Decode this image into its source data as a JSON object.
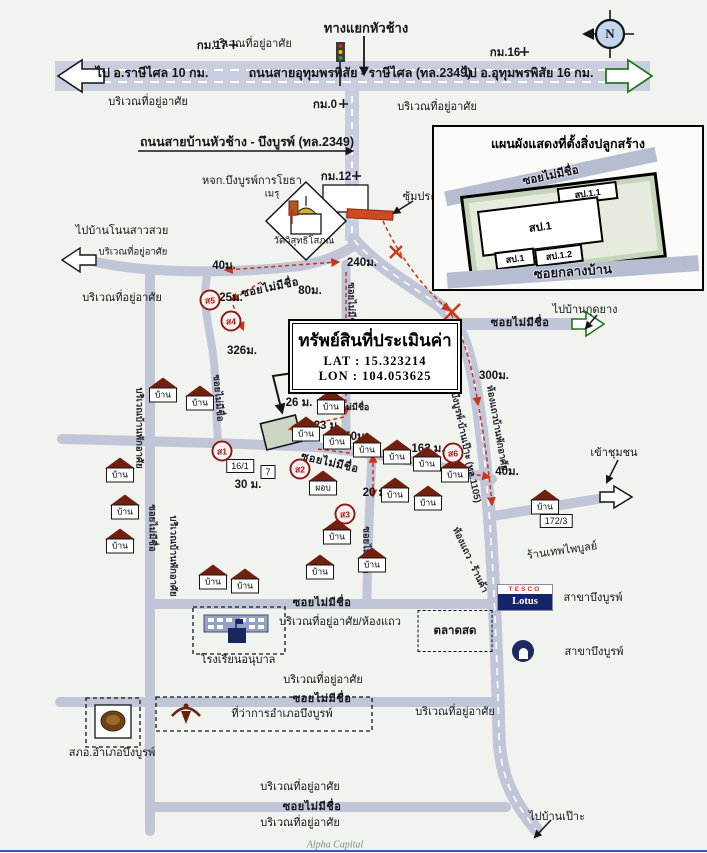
{
  "colors": {
    "road": "#c0c6d8",
    "road_band": "#c9cedf",
    "route": "#c93515",
    "roof": "#731f10",
    "green_arrow": "#1e7a1e",
    "lotus_navy": "#142468",
    "tesco_red": "#d42a10"
  },
  "property_box": {
    "title": "ทรัพย์สินที่ประเมินค่า",
    "lat": "LAT : 15.323214",
    "lon": "LON : 104.053625"
  },
  "inset": {
    "title": "แผนผังแสดงที่ตั้งสิ่งปลูกสร้าง",
    "road_top": "ซอยไม่มีชื่อ",
    "road_bottom": "ซอยกลางบ้าน",
    "b11": "สป.1.1",
    "b1": "สป.1",
    "b1s": "สป.1",
    "b12": "สป.1.2"
  },
  "lotus": {
    "tesco": "TESCO",
    "lotus": "Lotus"
  },
  "footer": {
    "brand": "Alpha Capital"
  },
  "house_label": "บ้าน",
  "labels": [
    {
      "t": "ทางแยกหัวช้าง",
      "x": 366,
      "y": 28,
      "c": "hdr",
      "n": "junction-label"
    },
    {
      "t": "บริเวณที่อยู่อาศัย",
      "x": 252,
      "y": 43,
      "c": "t",
      "n": "area-label"
    },
    {
      "t": "กม.17",
      "x": 212,
      "y": 46,
      "c": "b",
      "n": "km-marker-label"
    },
    {
      "t": "กม.16",
      "x": 505,
      "y": 53,
      "c": "b",
      "n": "km-marker-label"
    },
    {
      "t": "ไป อ.ราษีไศล 10 กม.",
      "x": 152,
      "y": 73,
      "c": "big",
      "n": "destination-label"
    },
    {
      "t": "ถนนสายอุทุมพรพิสัย - ราษีไศล (ทล.2349)",
      "x": 360,
      "y": 73,
      "c": "big",
      "n": "road-name-label"
    },
    {
      "t": "ไป อ.อุทุมพรพิสัย 16 กม.",
      "x": 528,
      "y": 73,
      "c": "big",
      "n": "destination-label"
    },
    {
      "t": "บริเวณที่อยู่อาศัย",
      "x": 148,
      "y": 101,
      "c": "t",
      "n": "area-label"
    },
    {
      "t": "กม.0",
      "x": 325,
      "y": 105,
      "c": "b",
      "n": "km-marker-label"
    },
    {
      "t": "บริเวณที่อยู่อาศัย",
      "x": 437,
      "y": 106,
      "c": "t",
      "n": "area-label"
    },
    {
      "t": "ถนนสายบ้านหัวช้าง - บึงบูรพ์ (ทล.2349)",
      "x": 247,
      "y": 142,
      "c": "big",
      "n": "road-name-label"
    },
    {
      "t": "หจก.บึงบูรพ์การโยธา",
      "x": 252,
      "y": 180,
      "c": "t",
      "n": "poi-label"
    },
    {
      "t": "กม.12",
      "x": 336,
      "y": 177,
      "c": "b",
      "n": "km-marker-label"
    },
    {
      "t": "ซุ้มประตู",
      "x": 423,
      "y": 196,
      "c": "t",
      "n": "gate-label"
    },
    {
      "t": "เมรุ",
      "x": 272,
      "y": 194,
      "c": "s",
      "n": "poi-label"
    },
    {
      "t": "วัดวิสุทธิโสภณ",
      "x": 304,
      "y": 241,
      "c": "s",
      "n": "temple-label"
    },
    {
      "t": "ไปบ้านโนนสาวสวย",
      "x": 122,
      "y": 230,
      "c": "t",
      "n": "destination-label"
    },
    {
      "t": "บริเวณที่อยู่อาศัย",
      "x": 133,
      "y": 252,
      "c": "s",
      "n": "area-label"
    },
    {
      "t": "บริเวณที่อยู่อาศัย",
      "x": 122,
      "y": 297,
      "c": "t",
      "n": "area-label"
    },
    {
      "t": "40ม.",
      "x": 224,
      "y": 266,
      "c": "b",
      "n": "distance-label"
    },
    {
      "t": "ซอยไม่มีชื่อ",
      "x": 270,
      "y": 287,
      "c": "rd",
      "r": -12,
      "n": "road-name-label"
    },
    {
      "t": "80ม.",
      "x": 310,
      "y": 291,
      "c": "b",
      "n": "distance-label"
    },
    {
      "t": "240ม.",
      "x": 362,
      "y": 263,
      "c": "b",
      "n": "distance-label"
    },
    {
      "t": "25ม.",
      "x": 231,
      "y": 298,
      "c": "b",
      "n": "distance-label"
    },
    {
      "t": "ซอยไม่มีชื่อ",
      "x": 351,
      "y": 306,
      "c": "rds",
      "r": 90,
      "n": "road-name-label"
    },
    {
      "t": "326ม.",
      "x": 242,
      "y": 351,
      "c": "b",
      "n": "distance-label"
    },
    {
      "t": "ซอยไม่มีชื่อ",
      "x": 218,
      "y": 398,
      "c": "rds",
      "r": 85,
      "n": "road-name-label"
    },
    {
      "t": "ไปบ้านกุดยาง",
      "x": 585,
      "y": 309,
      "c": "t",
      "n": "destination-label"
    },
    {
      "t": "ซอยไม่มีชื่อ",
      "x": 520,
      "y": 322,
      "c": "rd",
      "n": "road-name-label"
    },
    {
      "t": "300ม.",
      "x": 494,
      "y": 376,
      "c": "b",
      "n": "distance-label"
    },
    {
      "t": "ถนนสายบึงบูรพ์-บ้านเป๊าะ (ทล.1105)",
      "x": 462,
      "y": 430,
      "c": "rds",
      "r": 78,
      "n": "road-name-label"
    },
    {
      "t": "ห้องแถวบ้านพักอาศัย",
      "x": 497,
      "y": 428,
      "c": "rds",
      "r": 80,
      "n": "area-label"
    },
    {
      "t": "26 ม.",
      "x": 299,
      "y": 403,
      "c": "b",
      "n": "distance-label"
    },
    {
      "t": "ซอยไม่มีชื่อ",
      "x": 347,
      "y": 407,
      "c": "rds0",
      "n": "road-name-label"
    },
    {
      "t": "23 ม.",
      "x": 327,
      "y": 426,
      "c": "b",
      "n": "distance-label"
    },
    {
      "t": "50ม.",
      "x": 356,
      "y": 437,
      "c": "b",
      "n": "distance-label"
    },
    {
      "t": "ซอยไม่มีชื่อ",
      "x": 330,
      "y": 462,
      "c": "rd",
      "r": 13,
      "n": "road-name-label"
    },
    {
      "t": "162 ม.",
      "x": 428,
      "y": 449,
      "c": "b",
      "n": "distance-label"
    },
    {
      "t": "40ม.",
      "x": 507,
      "y": 472,
      "c": "b",
      "n": "distance-label"
    },
    {
      "t": "30 ม.",
      "x": 248,
      "y": 485,
      "c": "b",
      "n": "distance-label"
    },
    {
      "t": "20 ม.",
      "x": 376,
      "y": 493,
      "c": "b",
      "n": "distance-label"
    },
    {
      "t": "16/1",
      "x": 240,
      "y": 466,
      "c": "box",
      "n": "house-number-label"
    },
    {
      "t": "7",
      "x": 268,
      "y": 472,
      "c": "box",
      "n": "house-number-label"
    },
    {
      "t": "ซอยไม่มีชื่อ",
      "x": 366,
      "y": 550,
      "c": "rds",
      "r": 90,
      "n": "road-name-label"
    },
    {
      "t": "บริเวณบ้านพักอาศัย",
      "x": 139,
      "y": 428,
      "c": "rds",
      "r": 90,
      "n": "area-label"
    },
    {
      "t": "ซอยไม่มีชื่อ",
      "x": 152,
      "y": 528,
      "c": "rds",
      "r": 90,
      "n": "road-name-label"
    },
    {
      "t": "บริเวณบ้านพักอาศัย",
      "x": 173,
      "y": 556,
      "c": "rds",
      "r": 90,
      "n": "area-label"
    },
    {
      "t": "ห้องแถว - ร้านค้า",
      "x": 470,
      "y": 560,
      "c": "rds",
      "r": 65,
      "n": "area-label"
    },
    {
      "t": "เข้าชุมชน",
      "x": 614,
      "y": 452,
      "c": "t",
      "n": "destination-label"
    },
    {
      "t": "172/3",
      "x": 556,
      "y": 521,
      "c": "box",
      "n": "house-number-label"
    },
    {
      "t": "ร้านเทพไพบูลย์",
      "x": 562,
      "y": 550,
      "c": "t",
      "r": -8,
      "n": "poi-label"
    },
    {
      "t": "สาขาบึงบูรพ์",
      "x": 593,
      "y": 597,
      "c": "t",
      "n": "branch-label"
    },
    {
      "t": "สาขาบึงบูรพ์",
      "x": 594,
      "y": 651,
      "c": "t",
      "n": "branch-label"
    },
    {
      "t": "ซอยไม่มีชื่อ",
      "x": 322,
      "y": 602,
      "c": "rd",
      "n": "road-name-label"
    },
    {
      "t": "บริเวณที่อยู่อาศัย/ห้องแถว",
      "x": 340,
      "y": 621,
      "c": "t",
      "n": "area-label"
    },
    {
      "t": "ตลาดสด",
      "x": 455,
      "y": 631,
      "c": "mkt",
      "n": "market-label"
    },
    {
      "t": "โรงเรียนอนุบาล",
      "x": 238,
      "y": 659,
      "c": "t",
      "n": "school-label"
    },
    {
      "t": "บริเวณที่อยู่อาศัย",
      "x": 323,
      "y": 679,
      "c": "t",
      "n": "area-label"
    },
    {
      "t": "ซอยไม่มีชื่อ",
      "x": 322,
      "y": 698,
      "c": "rd",
      "n": "road-name-label"
    },
    {
      "t": "ที่ว่าการอำเภอบึงบูรพ์",
      "x": 282,
      "y": 713,
      "c": "t",
      "n": "district-office-label"
    },
    {
      "t": "บริเวณที่อยู่อาศัย",
      "x": 455,
      "y": 711,
      "c": "t",
      "n": "area-label"
    },
    {
      "t": "สภอ.อำเภอบึงบูรพ์",
      "x": 112,
      "y": 752,
      "c": "t",
      "n": "police-station-label"
    },
    {
      "t": "บริเวณที่อยู่อาศัย",
      "x": 300,
      "y": 786,
      "c": "t",
      "n": "area-label"
    },
    {
      "t": "ซอยไม่มีชื่อ",
      "x": 312,
      "y": 806,
      "c": "rd",
      "n": "road-name-label"
    },
    {
      "t": "บริเวณที่อยู่อาศัย",
      "x": 300,
      "y": 822,
      "c": "t",
      "n": "area-label"
    },
    {
      "t": "ไปบ้านเป๊าะ",
      "x": 557,
      "y": 816,
      "c": "t",
      "n": "destination-label"
    },
    {
      "t": "N",
      "x": 610,
      "y": 34,
      "c": "cmp",
      "n": "compass-n-label"
    }
  ],
  "houses": [
    {
      "x": 163,
      "y": 390
    },
    {
      "x": 200,
      "y": 398
    },
    {
      "x": 331,
      "y": 402
    },
    {
      "x": 120,
      "y": 470
    },
    {
      "x": 125,
      "y": 507
    },
    {
      "x": 120,
      "y": 541
    },
    {
      "x": 306,
      "y": 429
    },
    {
      "x": 337,
      "y": 437
    },
    {
      "x": 367,
      "y": 445
    },
    {
      "x": 397,
      "y": 452
    },
    {
      "x": 427,
      "y": 459
    },
    {
      "x": 455,
      "y": 470
    },
    {
      "x": 323,
      "y": 483,
      "t": "ผอบ"
    },
    {
      "x": 395,
      "y": 490
    },
    {
      "x": 428,
      "y": 498
    },
    {
      "x": 337,
      "y": 532
    },
    {
      "x": 320,
      "y": 567
    },
    {
      "x": 372,
      "y": 560
    },
    {
      "x": 213,
      "y": 577
    },
    {
      "x": 245,
      "y": 581
    },
    {
      "x": 545,
      "y": 502
    }
  ],
  "markers": [
    {
      "t": "ส5",
      "x": 210,
      "y": 300
    },
    {
      "t": "ส4",
      "x": 231,
      "y": 321
    },
    {
      "t": "ส1",
      "x": 222,
      "y": 451
    },
    {
      "t": "ส2",
      "x": 300,
      "y": 469
    },
    {
      "t": "ส3",
      "x": 345,
      "y": 514
    },
    {
      "t": "ส6",
      "x": 453,
      "y": 453
    }
  ]
}
